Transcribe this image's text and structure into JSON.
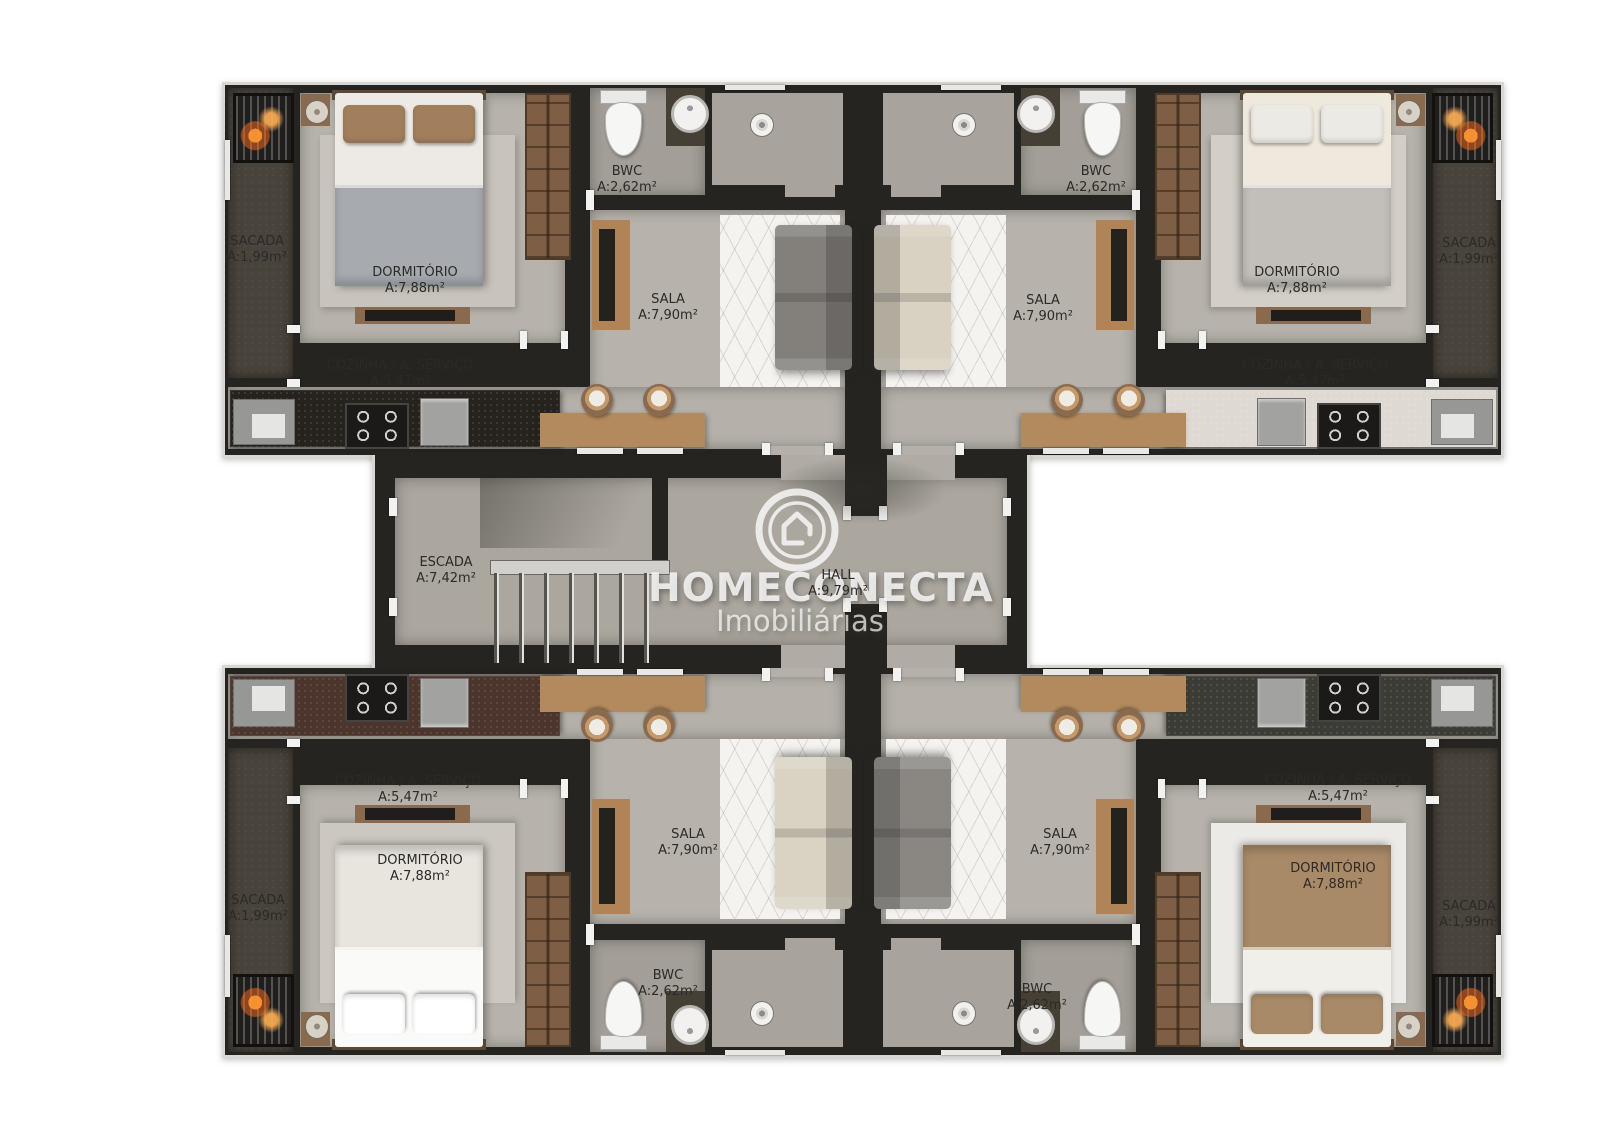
{
  "watermark": {
    "brand": "HOMECONECTA",
    "tagline": "Imobiliárias",
    "logo_icon": "house-in-circle-icon"
  },
  "core": {
    "escada": {
      "name": "ESCADA",
      "area": "A:7,42m²"
    },
    "hall": {
      "name": "HALL",
      "area": "A:9,79m²"
    }
  },
  "units": {
    "top_left": {
      "sacada": {
        "name": "SACADA",
        "area": "A:1,99m²"
      },
      "dormitorio": {
        "name": "DORMITÓRIO",
        "area": "A:7,88m²"
      },
      "bwc": {
        "name": "BWC",
        "area": "A:2,62m²"
      },
      "sala": {
        "name": "SALA",
        "area": "A:7,90m²"
      },
      "cozinha": {
        "name": "COZINHA / A. SERVIÇO",
        "area": "A:5,47m²"
      }
    },
    "top_right": {
      "sacada": {
        "name": "SACADA",
        "area": "A:1,99m²"
      },
      "dormitorio": {
        "name": "DORMITÓRIO",
        "area": "A:7,88m²"
      },
      "bwc": {
        "name": "BWC",
        "area": "A:2,62m²"
      },
      "sala": {
        "name": "SALA",
        "area": "A:7,90m²"
      },
      "cozinha": {
        "name": "COZINHA / A. SERVIÇO",
        "area": "A:5,47m²"
      }
    },
    "bottom_left": {
      "sacada": {
        "name": "SACADA",
        "area": "A:1,99m²"
      },
      "dormitorio": {
        "name": "DORMITÓRIO",
        "area": "A:7,88m²"
      },
      "bwc": {
        "name": "BWC",
        "area": "A:2,62m²"
      },
      "sala": {
        "name": "SALA",
        "area": "A:7,90m²"
      },
      "cozinha": {
        "name": "COZINHA / A. SERVIÇO",
        "area": "A:5,47m²"
      }
    },
    "bottom_right": {
      "sacada": {
        "name": "SACADA",
        "area": "A:1,99m²"
      },
      "dormitorio": {
        "name": "DORMITÓRIO",
        "area": "A:7,88m²"
      },
      "bwc": {
        "name": "BWC",
        "area": "A:2,62m²"
      },
      "sala": {
        "name": "SALA",
        "area": "A:7,90m²"
      },
      "cozinha": {
        "name": "COZINHA / A. SERVIÇO",
        "area": "A:5,47m²"
      }
    }
  },
  "colors": {
    "background": "#ffffff",
    "wall": "#262421",
    "unit_floor": "#b6b2ab",
    "core_floor": "#aba79f",
    "balcony_floor": "#48433b",
    "wood": "#b28a5e",
    "counter_top_left": "#26231f",
    "counter_top_right": "#dedad3",
    "counter_bottom_left": "#4c352c",
    "counter_bottom_right": "#3b3c35",
    "sofa_gray": "#83807c",
    "sofa_beige": "#d9d2c2",
    "ac_glow": "#ff9a3d",
    "watermark_text": "rgba(252,252,251,0.8)",
    "label_text": "#2b2a27"
  }
}
